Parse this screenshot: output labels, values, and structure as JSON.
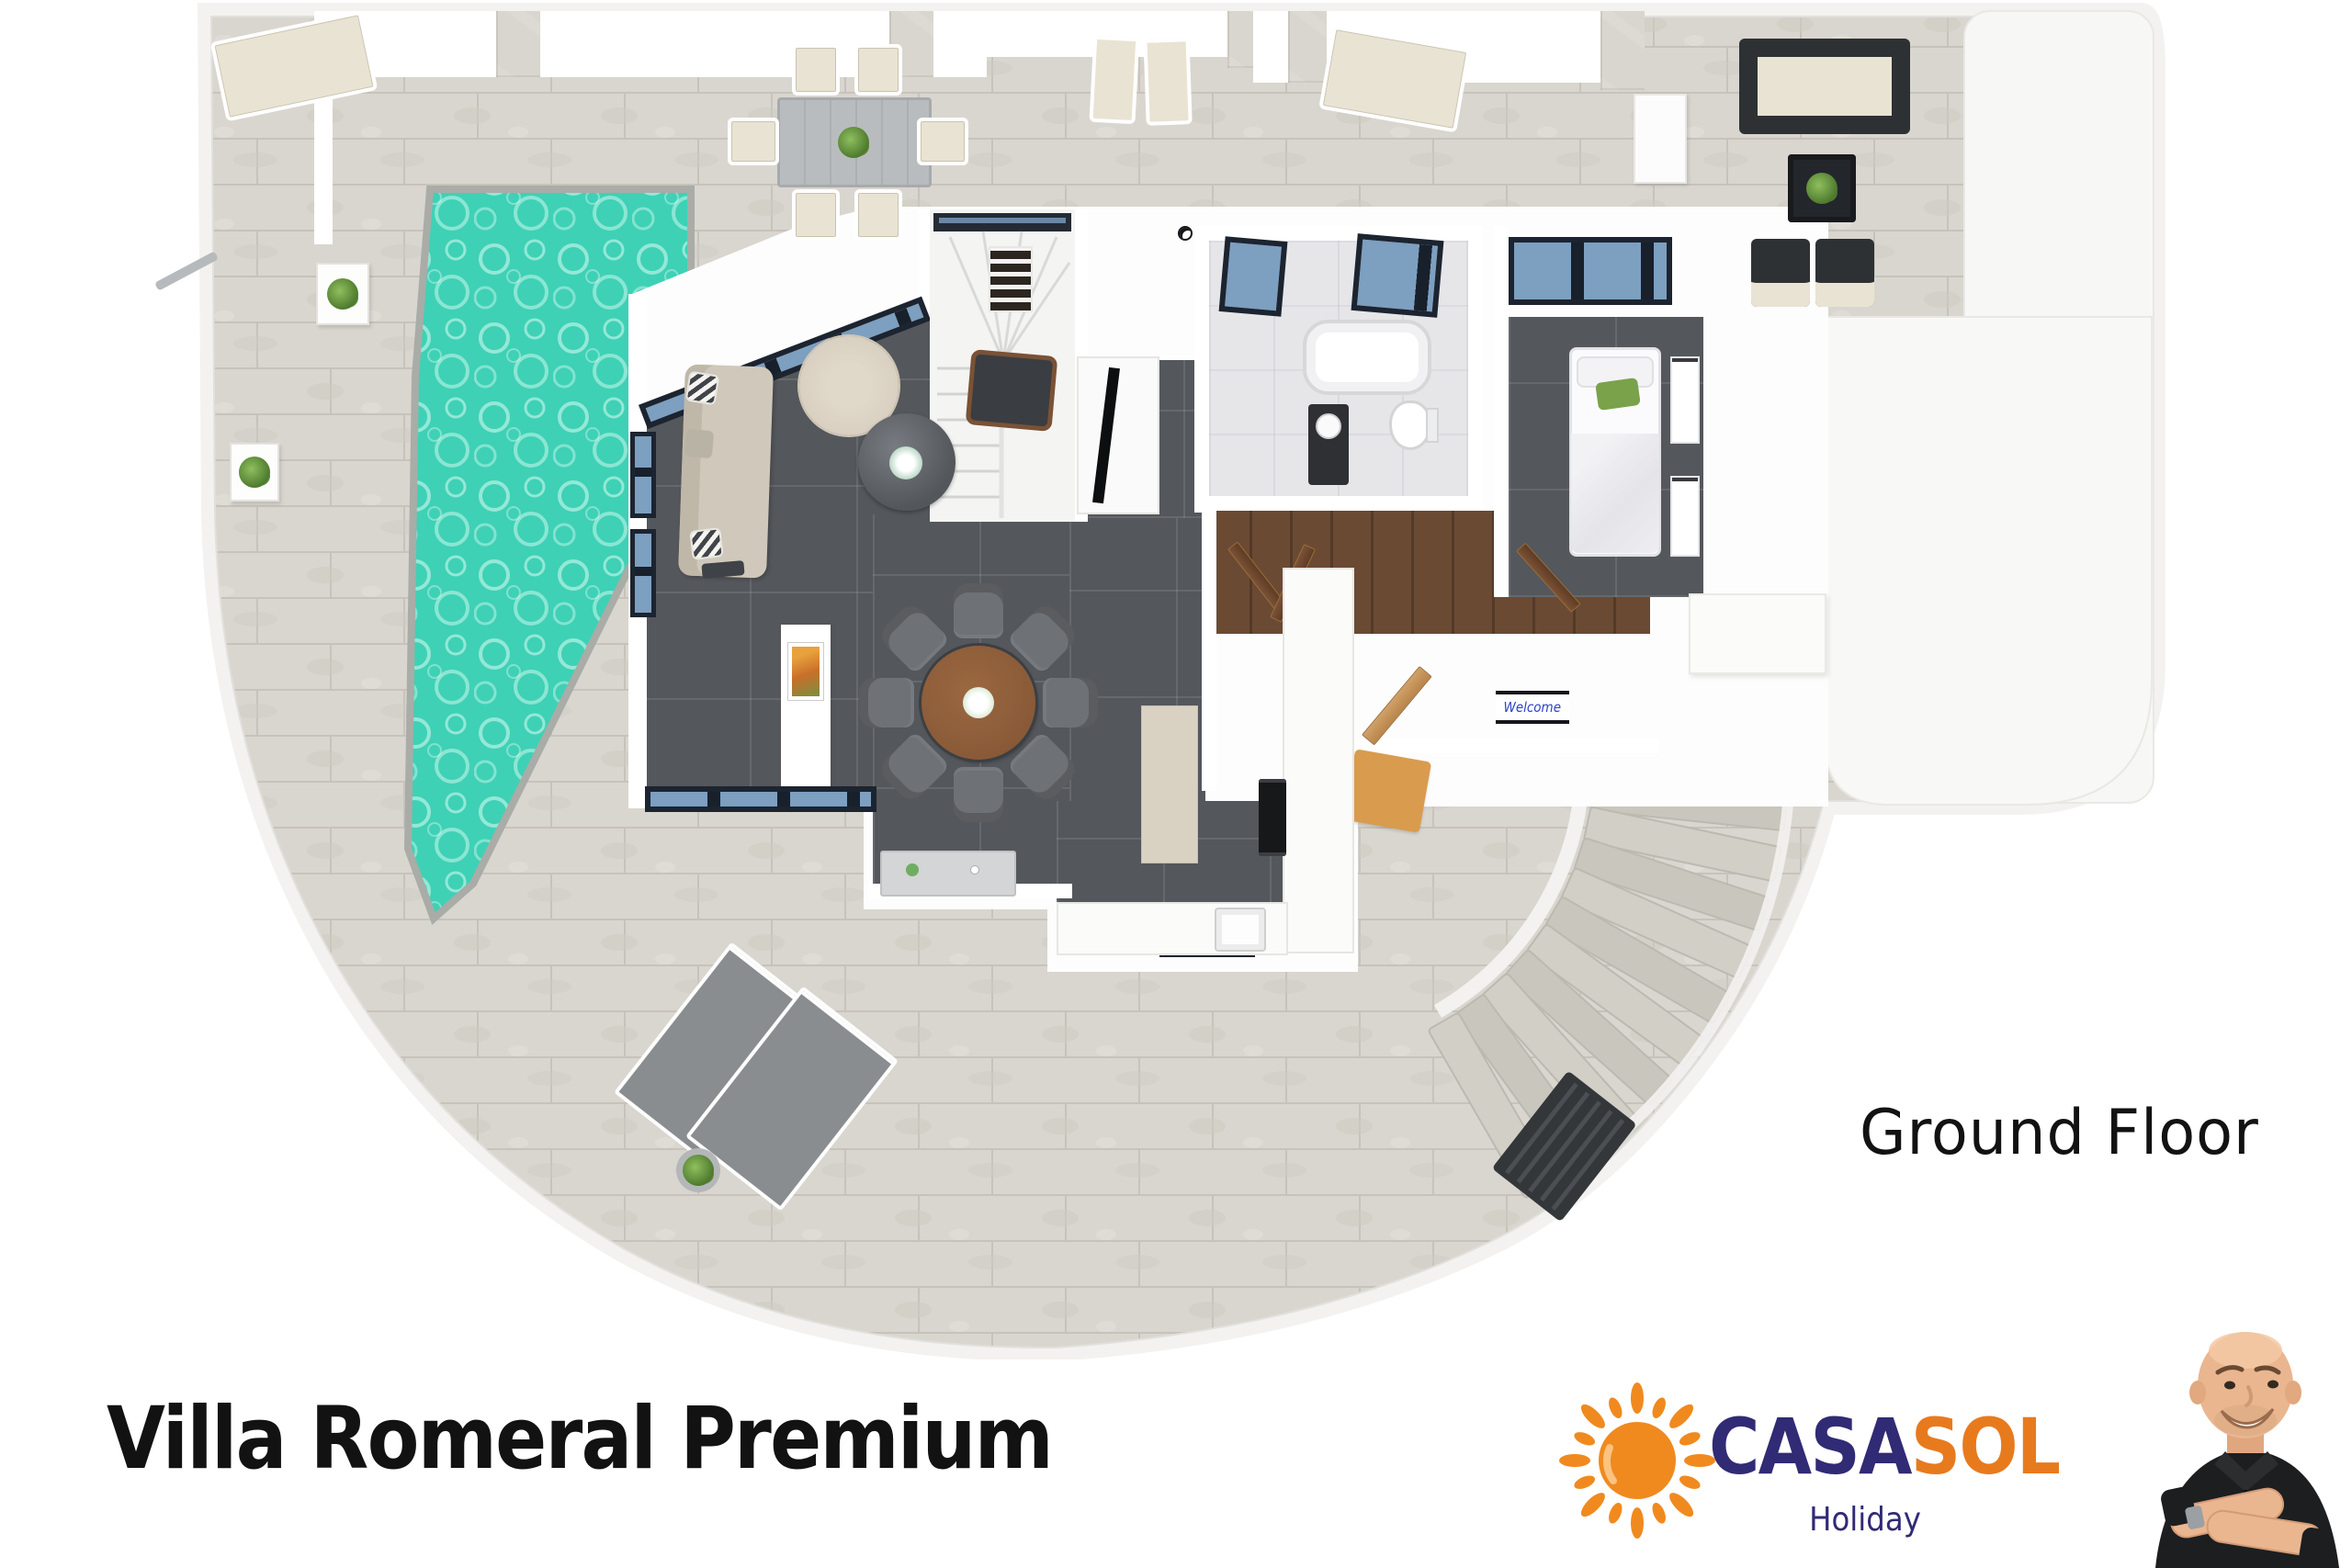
{
  "texts": {
    "title": "Villa Romeral Premium",
    "floor_label": "Ground Floor"
  },
  "brand": {
    "word_casa": "CASA",
    "word_sol": "SOL",
    "tagline": "Holiday"
  },
  "entrance": {
    "welcome_mat_text": "Welcome"
  },
  "palette": {
    "terrace": "#d9d6cf",
    "terrace_wall": "#f3f2f0",
    "pool_water": "#3ed1b5",
    "interior_dark_floor": "#54575b",
    "wood_floor": "#6b4a33",
    "bathroom_floor": "#e6e6e9",
    "glass": "#7d9fc0",
    "frame_dark": "#1c2430",
    "sofa": "#cfc8bb",
    "dining_table_wood": "#8a5a38",
    "chair_gray": "#6e7176",
    "rug": "#d8cfc0",
    "lounger_gray": "#8a8d8f",
    "outdoor_cushion": "#e9e3d3",
    "accent_green": "#7aa24a",
    "doormat": "#d99b4e",
    "gate": "#34373a",
    "logo_casa": "#312a75",
    "logo_sol": "#e87a1e",
    "logo_sun": "#f08a1f"
  }
}
